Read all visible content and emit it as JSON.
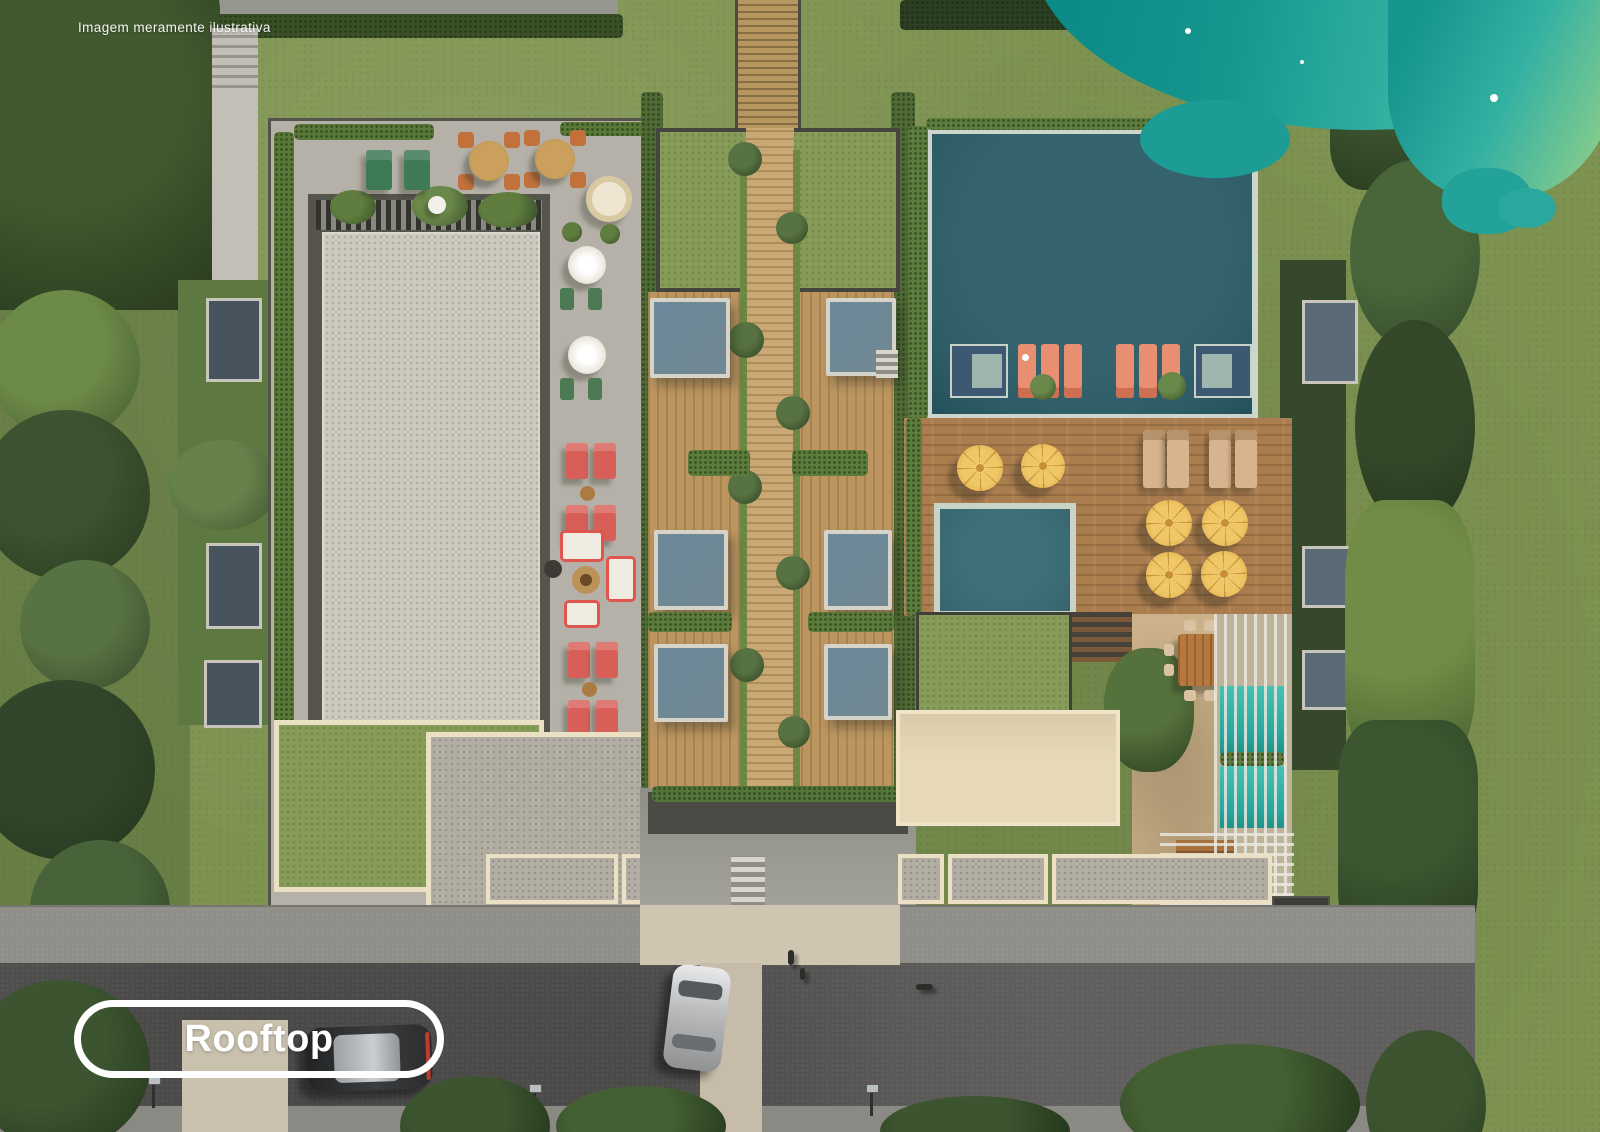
{
  "overlay": {
    "disclaimer": "Imagem meramente ilustrativa",
    "label": "Rooftop"
  },
  "palette": {
    "ocean": "#17968f",
    "ocean-shallow": "#a1d37f",
    "pool-main": "#2d5c66",
    "pool-plunge": "#36656f",
    "pool-lap": "#27a79e",
    "lawn": "#7e9352",
    "hedge": "#57753a",
    "trees": "#31462a",
    "deck-wood": "#aa7d4f",
    "walkway-wood": "#c9a873",
    "roof-gray": "#b5b1a8",
    "court-light": "#cec9bf",
    "cream": "#ece0c4",
    "street": "#605f5e",
    "sidewalk": "#8f8e88",
    "umbrella-yellow": "#eec45f",
    "lounger-red": "#d75f57",
    "lounger-salmon": "#e88e71",
    "lounger-tan": "#d8b48e",
    "lounger-green": "#3e7a54",
    "daybed-blue": "#6e8b9d",
    "label-white": "#ffffff"
  },
  "scene_elements": [
    "main-pool",
    "in-pool-loungers",
    "pool-deck",
    "yellow-umbrellas",
    "plunge-pool",
    "pergola-lap-pool",
    "outdoor-dining-table",
    "green-roofs",
    "private-deck-units",
    "central-boardwalk",
    "lounge-court",
    "fire-pit-lounge",
    "street",
    "parked-cars",
    "palm-trees",
    "ocean-edge"
  ]
}
